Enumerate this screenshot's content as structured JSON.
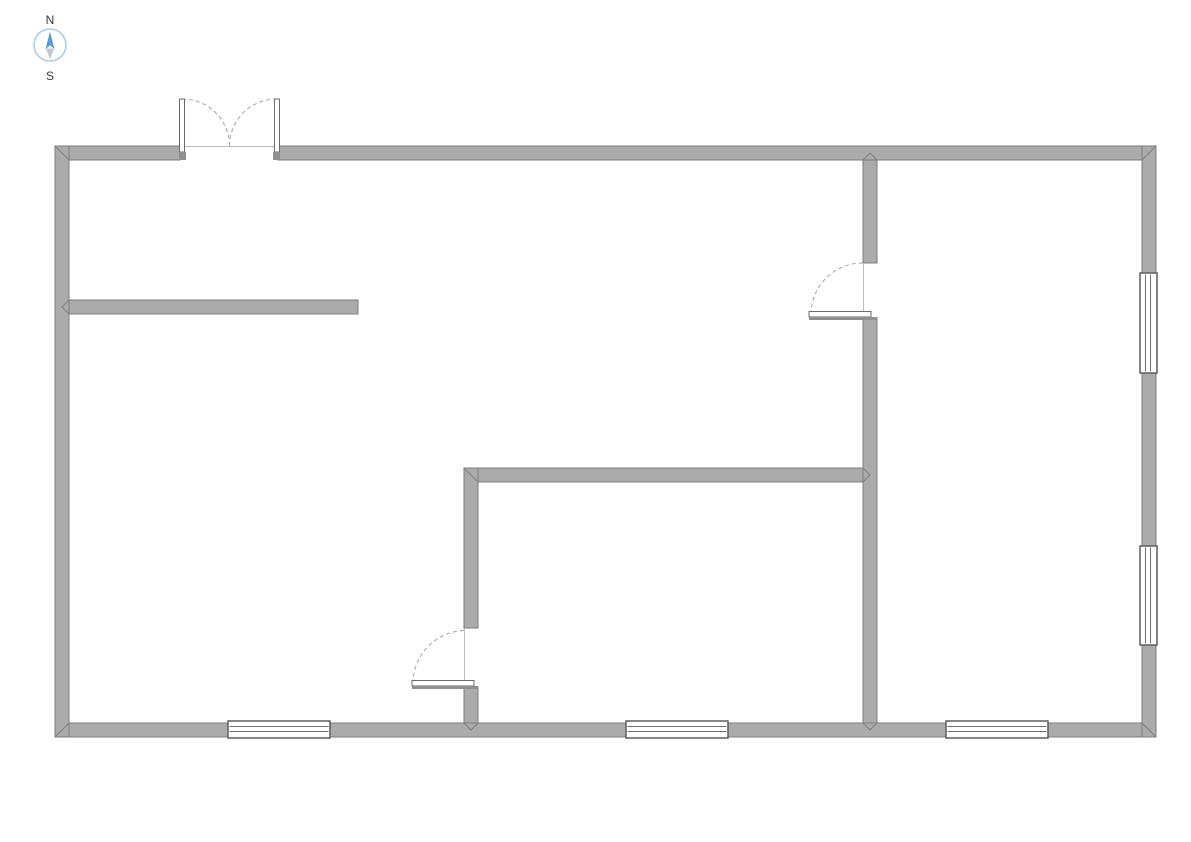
{
  "compass": {
    "north_label": "N",
    "south_label": "S",
    "cx": 50,
    "cy": 45,
    "r": 16,
    "north_label_x": 50,
    "north_label_y": 24,
    "south_label_x": 50,
    "south_label_y": 80,
    "circle_color": "#a5cde8",
    "north_needle_color": "#5b9bd5",
    "south_needle_color": "#c3c7cb",
    "north_needle_points": "50,31.5 45.5,49 50,45.5 54.5,49",
    "south_needle_points": "46,48.5 54,48.5 50,59.5"
  },
  "palette": {
    "background": "#ffffff",
    "wall_fill": "#ababab",
    "wall_stroke": "#7e7e7e",
    "window_fill": "#ffffff",
    "window_stroke": "#5e5e5e",
    "window_pane_stroke": "#6f6f6f",
    "door_panel_fill": "#ffffff",
    "door_panel_stroke": "#6b6b6b",
    "door_block_fill": "#8f8f8f",
    "arc_color": "#a3a3a3",
    "opening_line_color": "#bdbdbd"
  },
  "plan": {
    "canvas": {
      "width": 1191,
      "height": 842
    },
    "walls": [
      {
        "id": "left-exterior",
        "x": 55,
        "y": 146,
        "w": 14,
        "h": 591
      },
      {
        "id": "right-exterior",
        "x": 1142,
        "y": 146,
        "w": 14,
        "h": 591
      },
      {
        "id": "top-exterior-left",
        "x": 69,
        "y": 146,
        "w": 111,
        "h": 14
      },
      {
        "id": "top-exterior-right",
        "x": 278,
        "y": 146,
        "w": 864,
        "h": 14
      },
      {
        "id": "bottom-exterior",
        "x": 69,
        "y": 723,
        "w": 1073,
        "h": 14
      },
      {
        "id": "interior-vertical-right-upper",
        "x": 863,
        "y": 160,
        "w": 14,
        "h": 103
      },
      {
        "id": "interior-vertical-right-lower",
        "x": 863,
        "y": 318,
        "w": 14,
        "h": 405
      },
      {
        "id": "interior-horizontal-left",
        "x": 69,
        "y": 300,
        "w": 289,
        "h": 14
      },
      {
        "id": "interior-horizontal-middle",
        "x": 478,
        "y": 468,
        "w": 385,
        "h": 14
      },
      {
        "id": "interior-vertical-middle-upper",
        "x": 464,
        "y": 468,
        "w": 14,
        "h": 160
      },
      {
        "id": "interior-vertical-middle-lower",
        "x": 464,
        "y": 687,
        "w": 14,
        "h": 36
      }
    ],
    "joint_lines": [
      {
        "id": "miter-top-left",
        "points": "55,146 69,160"
      },
      {
        "id": "miter-top-right",
        "points": "1156,146 1142,160"
      },
      {
        "id": "miter-bottom-left",
        "points": "55,737 69,723"
      },
      {
        "id": "miter-bottom-right",
        "points": "1156,737 1142,723"
      },
      {
        "id": "miter-middle-corner",
        "points": "464,468 478,482"
      },
      {
        "id": "tjoint-right-wall-top",
        "points": "863,160 870,153 877,160"
      },
      {
        "id": "tjoint-right-wall-bottom",
        "points": "863,723 870,730 877,723"
      },
      {
        "id": "tjoint-left-partition",
        "points": "69,300 62,307 69,314"
      },
      {
        "id": "tjoint-middle-to-right",
        "points": "863,468 870,475 863,482"
      },
      {
        "id": "tjoint-middle-bottom",
        "points": "464,723 471,730 478,723"
      }
    ],
    "opening_lines": [
      {
        "id": "entry-threshold",
        "x1": 180,
        "y1": 146.5,
        "x2": 278,
        "y2": 146.5
      },
      {
        "id": "right-door-threshold",
        "x1": 863.5,
        "y1": 263,
        "x2": 863.5,
        "y2": 317
      },
      {
        "id": "middle-door-threshold",
        "x1": 464.5,
        "y1": 628,
        "x2": 464.5,
        "y2": 686
      }
    ],
    "windows": [
      {
        "id": "window-bottom-left",
        "orientation": "h",
        "x": 228,
        "y": 721,
        "w": 102,
        "h": 17
      },
      {
        "id": "window-bottom-middle",
        "orientation": "h",
        "x": 626,
        "y": 721,
        "w": 102,
        "h": 17
      },
      {
        "id": "window-bottom-right",
        "orientation": "h",
        "x": 946,
        "y": 721,
        "w": 102,
        "h": 17
      },
      {
        "id": "window-right-upper",
        "orientation": "v",
        "x": 1140,
        "y": 273,
        "w": 17,
        "h": 100
      },
      {
        "id": "window-right-lower",
        "orientation": "v",
        "x": 1140,
        "y": 546,
        "w": 17,
        "h": 99
      }
    ],
    "doors": [
      {
        "id": "entry-double-door",
        "arcs": [
          "M 182 99 A 47 47 0 0 1 229.5 146",
          "M 277 99 A 47 47 0 0 0 229.5 146"
        ],
        "panels": [
          {
            "x": 179.5,
            "y": 99,
            "w": 5,
            "h": 53
          },
          {
            "x": 274.5,
            "y": 99,
            "w": 5,
            "h": 53
          }
        ],
        "blocks": [
          {
            "x": 179,
            "y": 152,
            "w": 7,
            "h": 8
          },
          {
            "x": 273,
            "y": 152,
            "w": 7,
            "h": 8
          }
        ]
      },
      {
        "id": "interior-door-right-room",
        "arcs": [
          "M 811 314.5 A 51.5 51.5 0 0 1 862.5 263"
        ],
        "panels": [
          {
            "x": 809,
            "y": 311.5,
            "w": 62,
            "h": 5.5
          }
        ],
        "blocks": [
          {
            "x": 809,
            "y": 317,
            "w": 68,
            "h": 3
          }
        ]
      },
      {
        "id": "interior-door-middle-room",
        "arcs": [
          "M 413 683.5 A 53 53 0 0 1 466 630.5"
        ],
        "panels": [
          {
            "x": 412,
            "y": 680.5,
            "w": 62,
            "h": 5.5
          }
        ],
        "blocks": [
          {
            "x": 412,
            "y": 686,
            "w": 66,
            "h": 3
          }
        ]
      }
    ]
  }
}
